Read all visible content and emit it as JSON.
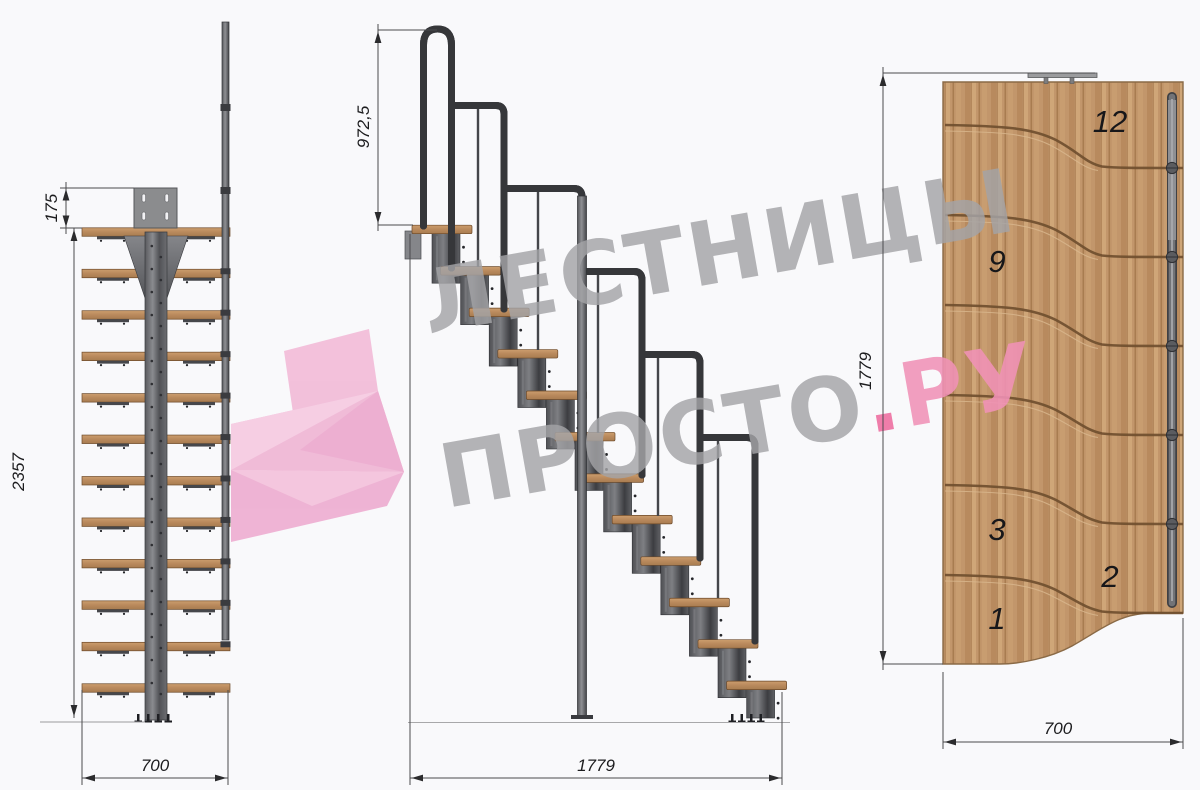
{
  "watermark": {
    "line1": "ЛЕСТНИЦЫ",
    "line2_gray": "ПРОСТО",
    "line2_dot": ".",
    "line2_pink": "РУ",
    "accent_pink": "#ee6d9f",
    "gray": "#a4a4a7"
  },
  "stairs": {
    "steps_total": 12
  },
  "front_view": {
    "dim_offset": "175",
    "dim_height": "2357",
    "dim_width": "700"
  },
  "side_view": {
    "dim_rail_height": "972,5",
    "dim_length": "1779"
  },
  "plan_view": {
    "dim_length": "1779",
    "dim_width": "700",
    "step_labels": [
      "12",
      "9",
      "3",
      "2",
      "1"
    ]
  },
  "colors": {
    "wood": "#c0936a",
    "wood_groove": "#6e4e2e",
    "steel_dark": "#46474b",
    "steel_mid": "#66676b",
    "dimension_line": "#4b4b4d"
  }
}
